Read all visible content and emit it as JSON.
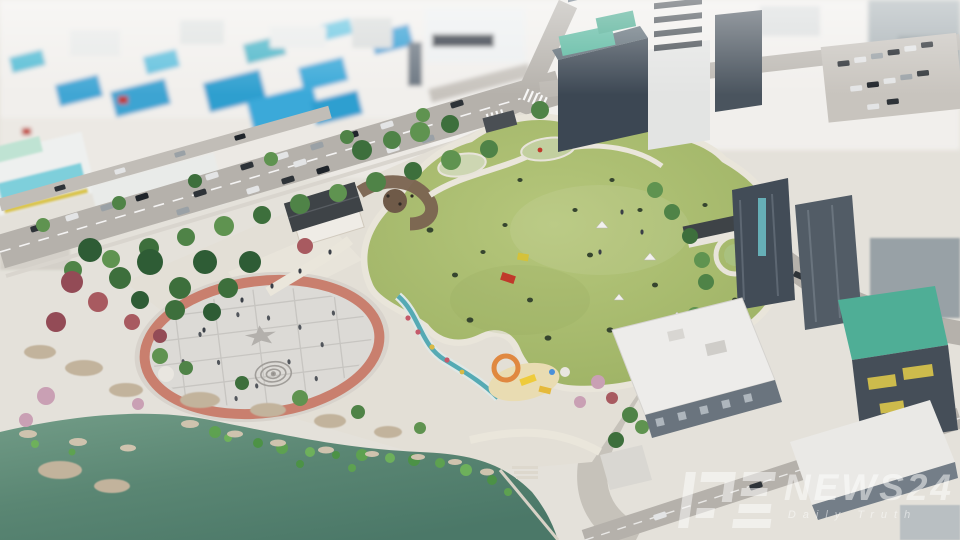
{
  "watermark": {
    "logo_name": "dt-news-logo",
    "title": "NEWS24",
    "tagline": "Daily Truth",
    "text_color": "#ffffff",
    "opacity": 0.5
  },
  "scene": {
    "type": "3d-aerial-architectural-render",
    "regions": [
      {
        "name": "north-city-blocks",
        "feature": "low-rise buildings with blue tarp roofs"
      },
      {
        "name": "northwest-boulevard",
        "feature": "diagonal street with parked cars and street trees"
      },
      {
        "name": "central-lawn",
        "feature": "organic oval great lawn with picnic tents and mats"
      },
      {
        "name": "event-plaza",
        "feature": "circular paved plaza with brick ring, star motif and spiral rings"
      },
      {
        "name": "pond",
        "feature": "teal lake with shoreline rocks and aquatic plants"
      },
      {
        "name": "playground",
        "feature": "sand pit with yellow slide and orange climber"
      },
      {
        "name": "stream",
        "feature": "landscaped water channel with flower border"
      },
      {
        "name": "park-facility-buildings",
        "feature": "white halls with dark gable roofs"
      },
      {
        "name": "east-office-towers",
        "feature": "glass towers with green rooftops"
      },
      {
        "name": "southeast-blocks",
        "feature": "white-roofed buildings, one with teal roof and yellow signs"
      },
      {
        "name": "parking-lot-northeast",
        "feature": "angled parking rows full of cars"
      }
    ]
  },
  "palette": {
    "lawn": "#a7b96c",
    "lawn_light": "#b6c77c",
    "lake": "#557f6e",
    "lake_deep": "#4b7868",
    "lake_shallow": "#729c87",
    "plaza": "#dcdad6",
    "plaza_ring": "#c97f6e",
    "road": "#b5b1ab",
    "walkway": "#eae6db",
    "sidewalk": "#d9d5ce",
    "sand": "#e9dcb2",
    "stream": "#55aab4",
    "roof_blue": "#3fa6d4",
    "roof_teal": "#4fae96",
    "roof_dark": "#3e4347",
    "building_white": "#eef0ef",
    "building_glass": "#3c4753",
    "sign_yellow": "#d9c54b",
    "tree_green": "#4f8347",
    "tree_pine": "#2e5c35",
    "tree_autumn": "#934b56",
    "tree_pink": "#c9a0b4",
    "shore": "#cfc3ae"
  }
}
